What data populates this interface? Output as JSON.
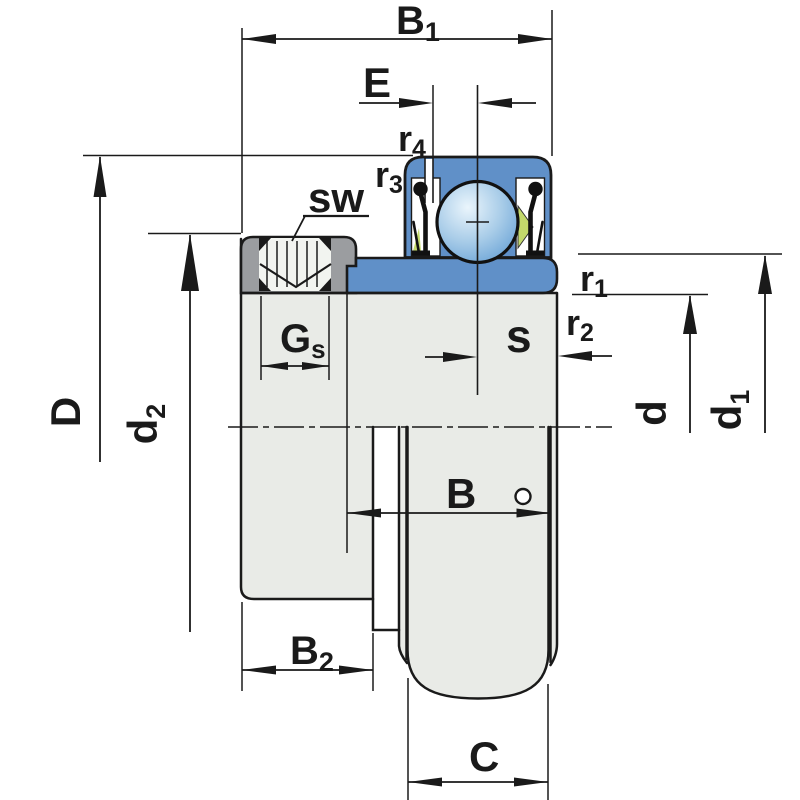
{
  "title": "Insert ball bearing with eccentric locking collar - dimension drawing",
  "colors": {
    "line": "#1a1a1a",
    "ring_blue": "#6090c8",
    "ball_light": "#eaf5fc",
    "ball_mid": "#a8cce8",
    "ball_dark": "#5e9bd3",
    "collar_gray": "#9b9da0",
    "body_gray": "#e9ebe7",
    "socket_light": "#f2f4f0",
    "cage_green": "#c3d96b",
    "background": "#ffffff"
  },
  "labels": {
    "b1": {
      "main": "B",
      "sub": "1"
    },
    "e": {
      "main": "E",
      "sub": ""
    },
    "r4": {
      "main": "r",
      "sub": "4"
    },
    "r3": {
      "main": "r",
      "sub": "3"
    },
    "sw": {
      "main": "sw",
      "sub": ""
    },
    "gs": {
      "main": "G",
      "sub": "s"
    },
    "d_big": {
      "main": "D",
      "sub": ""
    },
    "d2": {
      "main": "d",
      "sub": "2"
    },
    "s": {
      "main": "s",
      "sub": ""
    },
    "r1": {
      "main": "r",
      "sub": "1"
    },
    "r2": {
      "main": "r",
      "sub": "2"
    },
    "d": {
      "main": "d",
      "sub": ""
    },
    "d1": {
      "main": "d",
      "sub": "1"
    },
    "b": {
      "main": "B",
      "sub": ""
    },
    "b2": {
      "main": "B",
      "sub": "2"
    },
    "c": {
      "main": "C",
      "sub": ""
    }
  }
}
